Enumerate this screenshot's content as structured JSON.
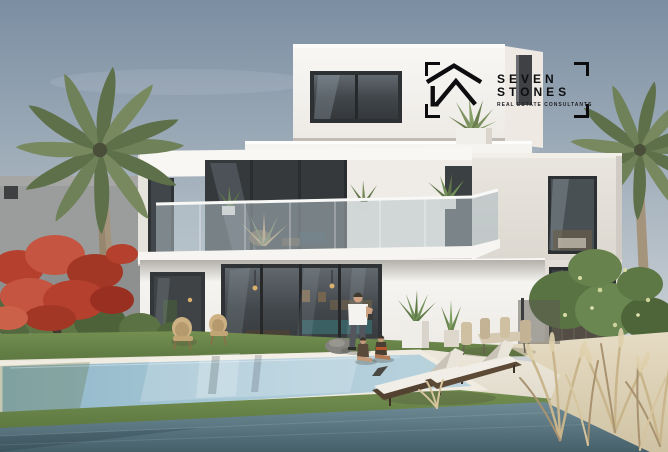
{
  "scene": {
    "description": "3D architectural rendering of a modern three-storey white villa with glass balconies, swimming pool, palm trees, red flame tree, sun loungers, outdoor dining set, a man with two children, waterfront lake and sandy bank with dry pampas grass"
  },
  "watermark": {
    "brand_line1": "SEVEN",
    "brand_line2": "STONES",
    "tagline": "REAL ESTATE CONSULTANTS",
    "icon": "house-outline-logo-icon",
    "text_color": "#0d0d0f",
    "frame": "corner-brackets"
  },
  "palette": {
    "sky_top": "#7b8ea2",
    "sky_horizon": "#d9dcde",
    "villa_white": "#f5f3ef",
    "villa_shadow_wall": "#ddd9d2",
    "window_glass": "#3c4043",
    "pool_water": "#9fc3d4",
    "lake_water": "#5d7b86",
    "lawn_green": "#66834a",
    "palm_green": "#6e8158",
    "flame_tree_red": "#b8422f",
    "sand": "#ddd2b8",
    "deck_stone": "#e8e3d6",
    "lounger_wicker": "#53422f",
    "cushion_white": "#f1eee7"
  }
}
